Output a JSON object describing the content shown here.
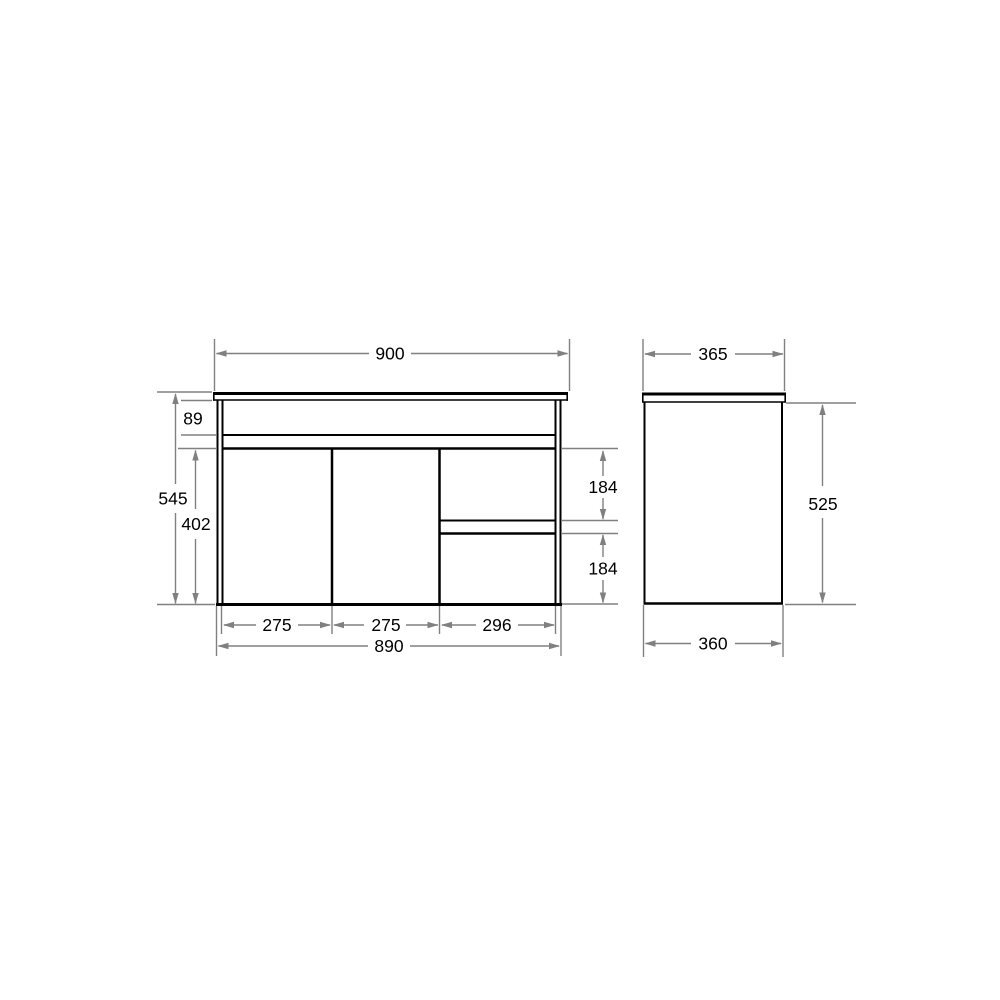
{
  "front_view": {
    "overall_width": "900",
    "top_rail_height": "89",
    "overall_height": "545",
    "door_height": "402",
    "upper_drawer_height": "184",
    "lower_drawer_height": "184",
    "left_door_width": "275",
    "middle_door_width": "275",
    "drawer_bank_width": "296",
    "carcass_width": "890"
  },
  "side_view": {
    "top_depth": "365",
    "carcass_height": "525",
    "carcass_depth": "360"
  },
  "style": {
    "background": "#ffffff",
    "outline_color": "#000000",
    "dimension_color": "#808080",
    "label_color": "#000000"
  }
}
